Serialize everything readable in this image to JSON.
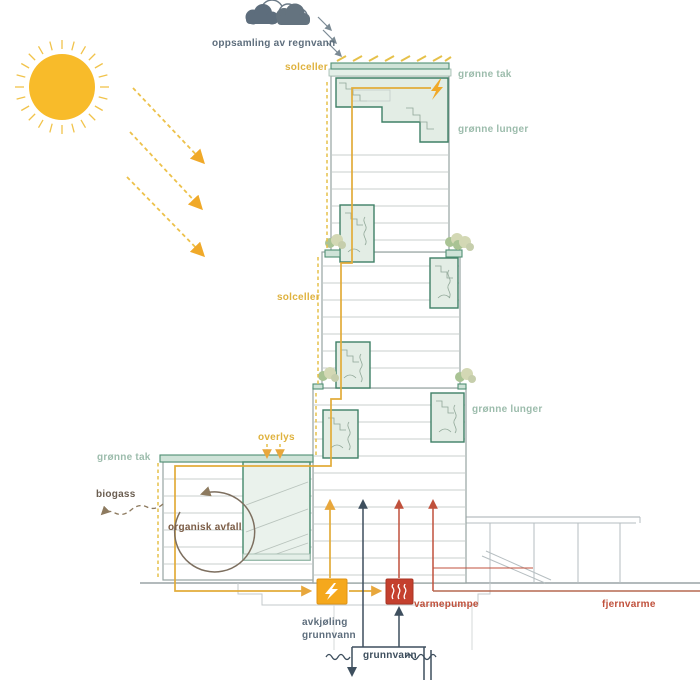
{
  "diagram": {
    "kind": "sustainable-building-energy-concept-section",
    "language": "Norwegian"
  },
  "labels": {
    "rain_collection": "oppsamling av regnvann",
    "solar_cells_top": "solceller",
    "green_roof_tower": "grønne tak",
    "green_lungs_upper": "grønne lunger",
    "solar_cells_mid": "solceller",
    "green_lungs_lower": "grønne lunger",
    "skylight": "overlys",
    "green_roof_podium": "grønne tak",
    "biogas": "biogass",
    "organic_waste": "organisk avfall",
    "heat_pump": "varmepumpe",
    "cooling_line1": "avkjøling",
    "cooling_line2": "grunnvann",
    "groundwater": "grunnvann",
    "district_heating": "fjernvarme"
  },
  "icons": {
    "sun": "sun-icon",
    "rain_cloud": "rain-cloud-icon",
    "roof_electricity": "lightning-bolt-icon",
    "electricity_box": "lightning-bolt-icon",
    "heat_pump_box": "heat-coil-icon",
    "setback_trees": "tree-icon",
    "groundwater_level": "water-level-icon"
  },
  "colors": {
    "sun": "#F8BB2A",
    "solar_line_yellow": "#E2AC3A",
    "label_yellow": "#DFB23E",
    "green_label": "#9CBCAC",
    "green_dark": "#3F8066",
    "green_fill": "#E3EDE5",
    "roof_fill": "#CFE3D8",
    "slate": "#5D6D7C",
    "electric_orange": "#F5A81C",
    "heat_red": "#C4402E",
    "district_red": "#C0513C",
    "navy": "#3E4F5E",
    "biogas_brown": "#8D7A5F",
    "floor_gray": "#C9CFCE"
  }
}
